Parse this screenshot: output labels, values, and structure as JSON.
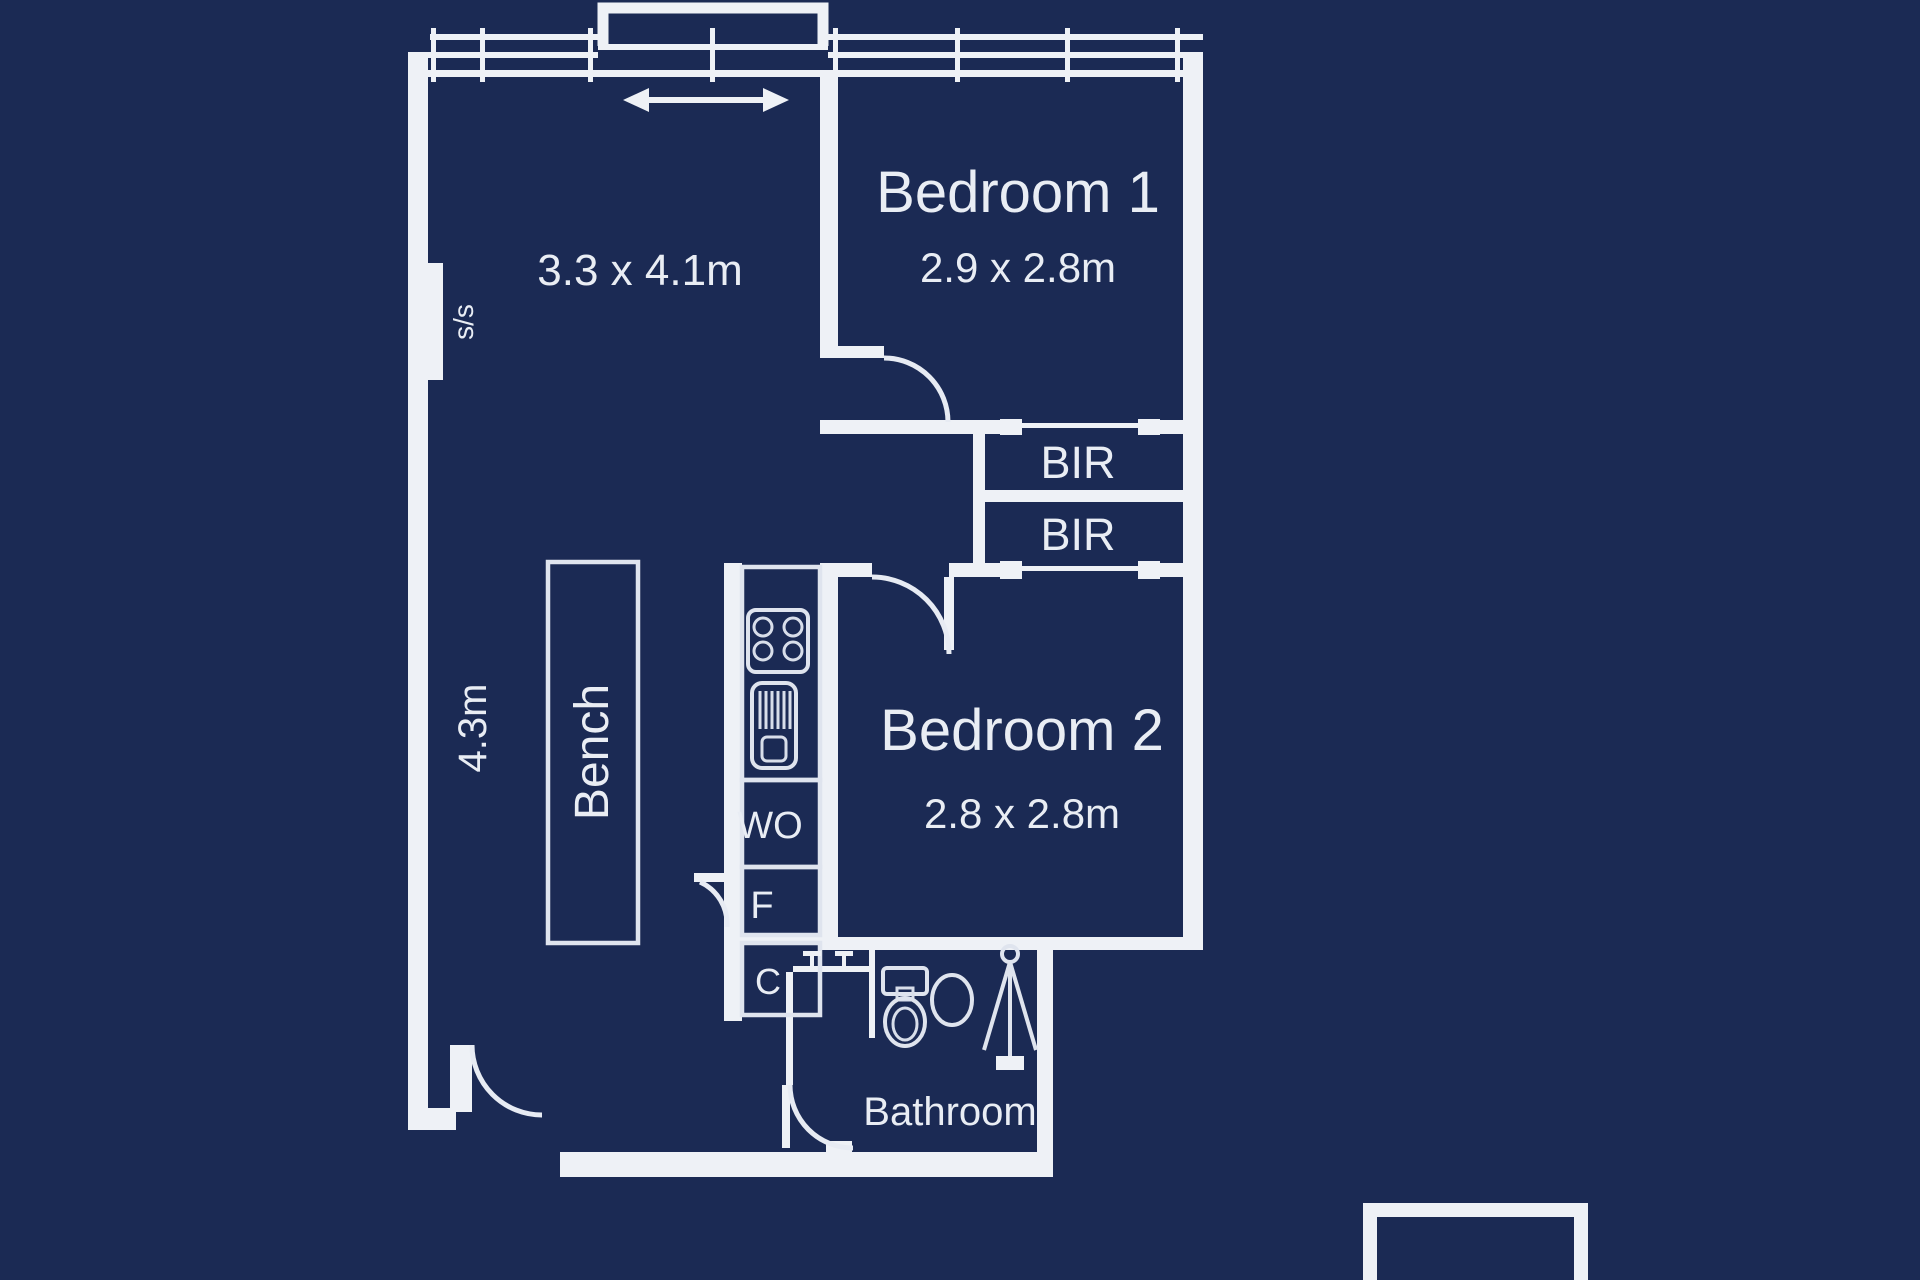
{
  "plan": {
    "background_color": "#1b2a54",
    "line_color": "#eef1f6",
    "living": {
      "dims": "3.3 x 4.1m",
      "depth": "4.3m",
      "wall_label": "s/s"
    },
    "bedroom1": {
      "name": "Bedroom 1",
      "dims": "2.9 x 2.8m"
    },
    "bedroom2": {
      "name": "Bedroom 2",
      "dims": "2.8 x 2.8m"
    },
    "bathroom": {
      "name": "Bathroom"
    },
    "kitchen": {
      "bench": "Bench",
      "wall_oven": "WO",
      "fridge": "F",
      "cupboard": "C"
    },
    "robes": {
      "bir1": "BIR",
      "bir2": "BIR"
    }
  }
}
